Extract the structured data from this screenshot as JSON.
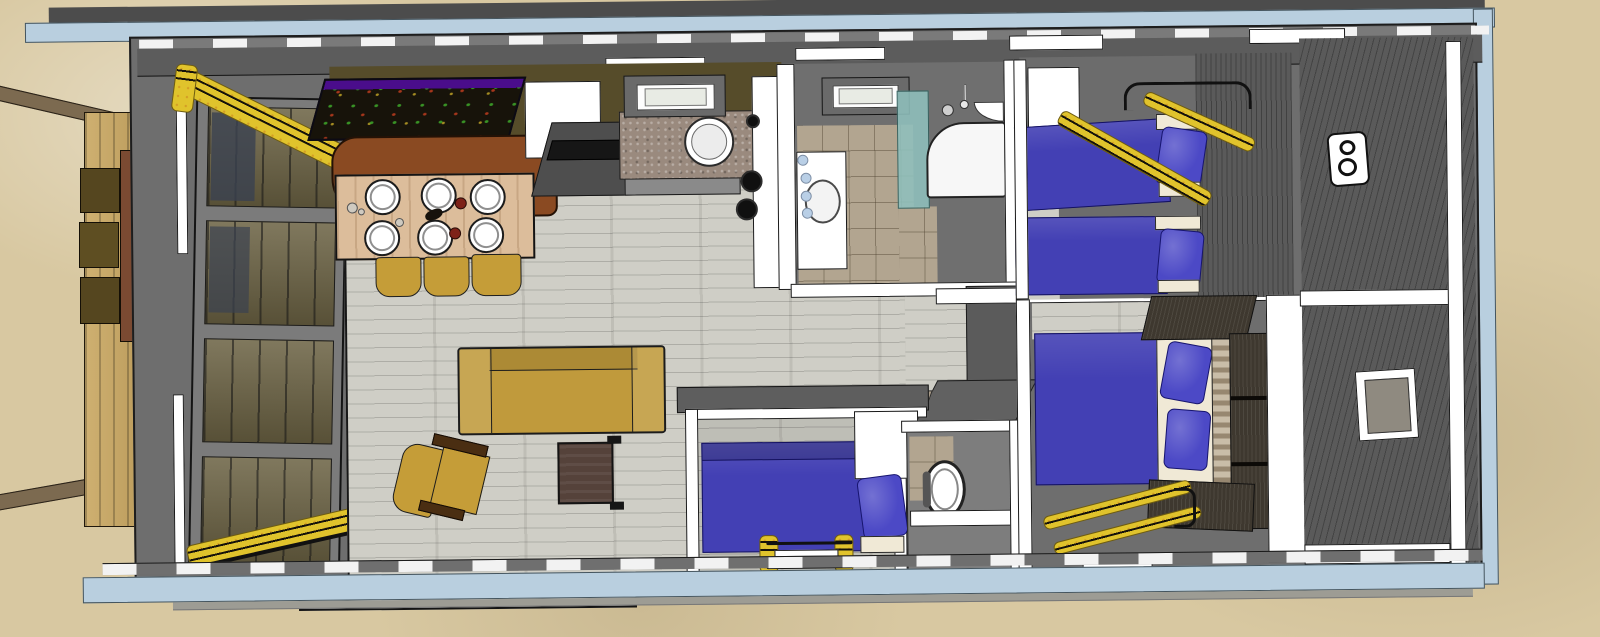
{
  "scene": {
    "description": "3D top-down architectural render of a houseboat floor plan moored at a wooden dock on sand; no text labels are visible in the image",
    "colors": {
      "sand": "#d8c8a1",
      "hull_trim": "#b9cfdf",
      "hull_dark_band": "#4c4c4c",
      "deck": "#6e6e6e",
      "deck_dark": "#5a5a5a",
      "roof_band": "#5c5c5c",
      "wall_white": "#ffffff",
      "wall_olive": "#564c2a",
      "floor_wood": "#cfcec6",
      "floor_tile": "#b2a590",
      "dock_wood": "#c6a258",
      "beam_brown": "#7c6a50",
      "step_brown": "#55461f",
      "door_brown": "#7b4a32",
      "awning_yellow": "#e0c32c",
      "table_wood": "#dcbd9b",
      "bench_brown": "#8a4a22",
      "chair_mustard": "#c59d38",
      "sofa_mustard": "#c09a3c",
      "coffee_table": "#55423a",
      "counter_granite": "#9a8a7e",
      "cabinet_grey": "#4e4e4e",
      "bed_blue": "#4340b4",
      "pillow_blue": "#4c49c6",
      "sheet_cream": "#f0e9d6",
      "wardrobe_dark": "#3e382f",
      "headboard_wood": "#c9bda8",
      "shower_glass": "#8fc0bd",
      "skylight_glass": "#e8ebe4",
      "painting_bg": "#17130a",
      "painting_edge": "#4a0d8b",
      "bulb_blue": "#b9cfe6"
    },
    "objects": [
      {
        "name": "wooden-dock-with-steps"
      },
      {
        "name": "mooring-beams"
      },
      {
        "name": "glazed-entrance-facade"
      },
      {
        "name": "rolled-yellow-awnings"
      },
      {
        "name": "dining-table-six-place-settings"
      },
      {
        "name": "curved-dining-bench"
      },
      {
        "name": "three-dining-chairs"
      },
      {
        "name": "wall-artwork"
      },
      {
        "name": "mustard-sofa"
      },
      {
        "name": "mustard-armchair"
      },
      {
        "name": "coffee-table"
      },
      {
        "name": "kitchen-counter-with-round-sink"
      },
      {
        "name": "cooktop-burners"
      },
      {
        "name": "fridge-cabinet"
      },
      {
        "name": "two-skylights"
      },
      {
        "name": "bathroom-vanity-with-basin"
      },
      {
        "name": "shower-with-teal-glass"
      },
      {
        "name": "wc-toilet"
      },
      {
        "name": "single-bed-cabin"
      },
      {
        "name": "twin-bed-cabin"
      },
      {
        "name": "double-bed-master-cabin"
      },
      {
        "name": "wardrobe-dark-panels"
      },
      {
        "name": "yellow-boarding-ladders"
      },
      {
        "name": "rear-deck-with-outdoor-light"
      },
      {
        "name": "hull-window"
      }
    ]
  }
}
